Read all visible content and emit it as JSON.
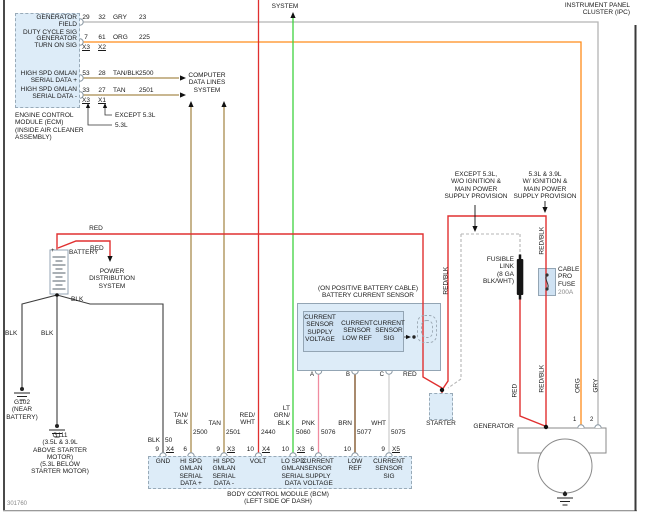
{
  "doc_number": "301760",
  "ipc_label": "INSTRUMENT PANEL\nCLUSTER (IPC)",
  "ecm": {
    "signals": [
      "GENERATOR FIELD\nDUTY CYCLE SIG",
      "GENERATOR\nTURN ON SIG",
      "HIGH SPD GMLAN\nSERIAL DATA +",
      "HIGH SPD GMLAN\nSERIAL DATA -"
    ],
    "rows": [
      {
        "pin_a": "29",
        "pin_b": "32",
        "color": "GRY",
        "circuit": "23"
      },
      {
        "pin_a": "7",
        "pin_b": "61",
        "color": "ORG",
        "circuit": "225"
      },
      {
        "pin_a": "53",
        "pin_b": "28",
        "color": "TAN/BLK",
        "circuit": "2500"
      },
      {
        "pin_a": "33",
        "pin_b": "27",
        "color": "TAN",
        "circuit": "2501"
      }
    ],
    "connectors_top": [
      "X3",
      "X2"
    ],
    "connectors_bottom": [
      "X3",
      "X1"
    ],
    "variant_except": "EXCEPT 5.3L",
    "variant_53": "5.3L",
    "caption": "ENGINE CONTROL\nMODULE (ECM)\n(INSIDE AIR CLEANER\nASSEMBLY)"
  },
  "computer_data_lines": "COMPUTER\nDATA LINES\nSYSTEM",
  "battery": {
    "label": "BATTERY",
    "plus": "+"
  },
  "power_distribution": "POWER\nDISTRIBUTION\nSYSTEM",
  "grounds": {
    "g102": "G102\n(NEAR\nBATTERY)",
    "g111": "G111\n(3.5L & 3.9L\nABOVE STARTER\nMOTOR)\n(5.3L BELOW\nSTARTER MOTOR)"
  },
  "wire_labels": {
    "red": "RED",
    "red_blk": "RED/BLK",
    "blk": "BLK",
    "org": "ORG",
    "gry": "GRY"
  },
  "sensor": {
    "caption": "(ON POSITIVE BATTERY CABLE)\nBATTERY CURRENT SENSOR",
    "channels": [
      "CURRENT\nSENSOR\nSUPPLY\nVOLTAGE",
      "CURRENT\nSENSOR\nLOW REF",
      "CURRENT\nSENSOR\nSIG"
    ],
    "terminals": [
      "A",
      "B",
      "C"
    ]
  },
  "bcm": {
    "caption": "BODY CONTROL MODULE (BCM)\n(LEFT SIDE OF DASH)",
    "pins": [
      {
        "color": "BLK",
        "circuit": "50",
        "pin": "9",
        "conn": "X4",
        "name": "GND"
      },
      {
        "color": "TAN/\nBLK",
        "circuit": "2500",
        "pin": "6",
        "conn": "",
        "name": "HI SPD\nGMLAN\nSERIAL\nDATA +"
      },
      {
        "color": "TAN",
        "circuit": "2501",
        "pin": "9",
        "conn": "X3",
        "name": "HI SPD\nGMLAN\nSERIAL\nDATA -"
      },
      {
        "color": "RED/\nWHT",
        "circuit": "2440",
        "pin": "10",
        "conn": "X4",
        "name": "VOLT"
      },
      {
        "color": "LT\nGRN/\nBLK",
        "circuit": "5060",
        "pin": "10",
        "conn": "X3",
        "name": "LO SPD\nGMLAN\nSERIAL\nDATA"
      },
      {
        "color": "PNK",
        "circuit": "5076",
        "pin": "6",
        "conn": "",
        "name": "CURRENT\nSENSOR\nSUPPLY\nVOLTAGE"
      },
      {
        "color": "BRN",
        "circuit": "5077",
        "pin": "10",
        "conn": "",
        "name": "LOW\nREF"
      },
      {
        "color": "WHT",
        "circuit": "5075",
        "pin": "9",
        "conn": "X5",
        "name": "CURRENT\nSENSOR\nSIG"
      }
    ]
  },
  "fusible_link": "FUSIBLE\nLINK\n(8 GA\nBLK/WHT)",
  "cable_pro_fuse": {
    "name": "CABLE\nPRO\nFUSE",
    "rating": "200A"
  },
  "starter_label": "STARTER",
  "generator": {
    "label": "GENERATOR",
    "terminal_1": "1",
    "terminal_2": "2"
  },
  "annotations": {
    "except_53": "EXCEPT 5.3L,\nW/O IGNITION &\nMAIN POWER\nSUPPLY PROVISION",
    "with_53_39": "5.3L & 3.9L\nW/ IGNITION &\nMAIN POWER\nSUPPLY PROVISION"
  },
  "colors": {
    "red": "#e03030",
    "orange": "#ff8c1a",
    "gray": "#b4b4b4",
    "tan": "#a98c4f",
    "lt_green": "#3fd23f",
    "pink": "#f08ca0",
    "brown": "#7a4a1e",
    "white_wire": "#d0d0d0",
    "black_wire": "#3c3c3c",
    "module_fill": "#ddecf8"
  }
}
